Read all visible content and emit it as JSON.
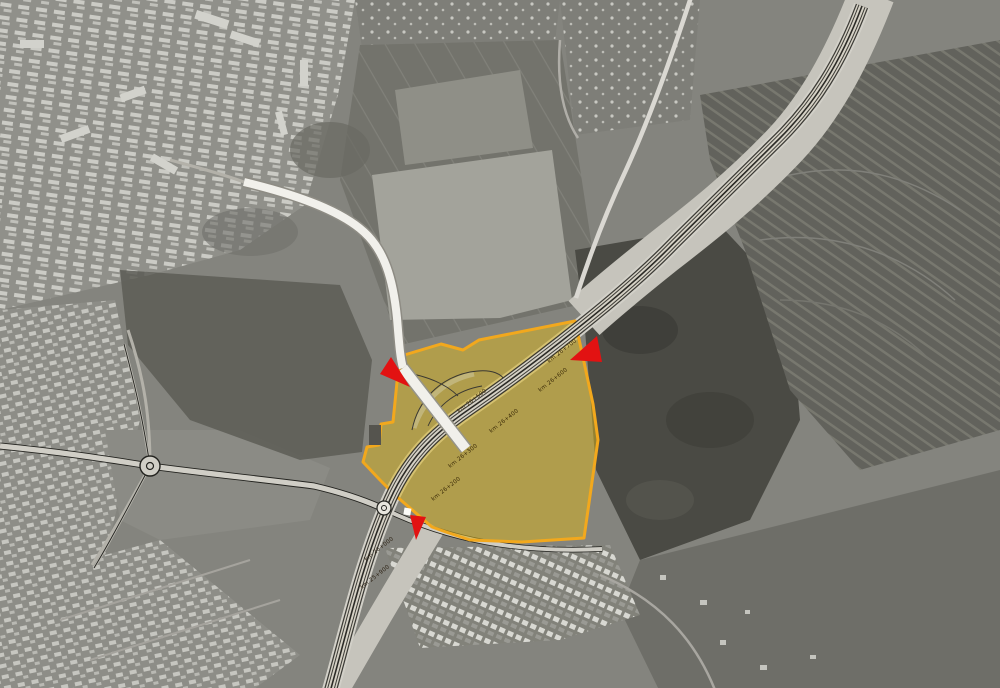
{
  "map": {
    "colors": {
      "site_fill": "#d9b41e",
      "site_border": "#f2a81d",
      "arrow": "#e21212",
      "alignment_line": "#2b2a26",
      "road_fill": "#f1f0eb",
      "corridor": "#c6c4bc"
    },
    "site_overlay": {
      "kind": "highlighted development site polygon",
      "fill_opacity": "0.52"
    },
    "chainage_labels": [
      {
        "text": "km 26+700"
      },
      {
        "text": "km 26+600"
      },
      {
        "text": "km 26+500"
      },
      {
        "text": "km 26+400"
      },
      {
        "text": "km 26+300"
      },
      {
        "text": "km 26+200"
      },
      {
        "text": "km 26+000"
      },
      {
        "text": "km 25+900"
      }
    ],
    "arrows": [
      {
        "name": "access-arrow-northwest",
        "direction": "southeast"
      },
      {
        "name": "access-arrow-northeast",
        "direction": "southwest"
      },
      {
        "name": "access-arrow-south",
        "direction": "south"
      }
    ],
    "markers": [
      {
        "name": "boundary-corner-marker",
        "shape": "white-square"
      }
    ]
  }
}
